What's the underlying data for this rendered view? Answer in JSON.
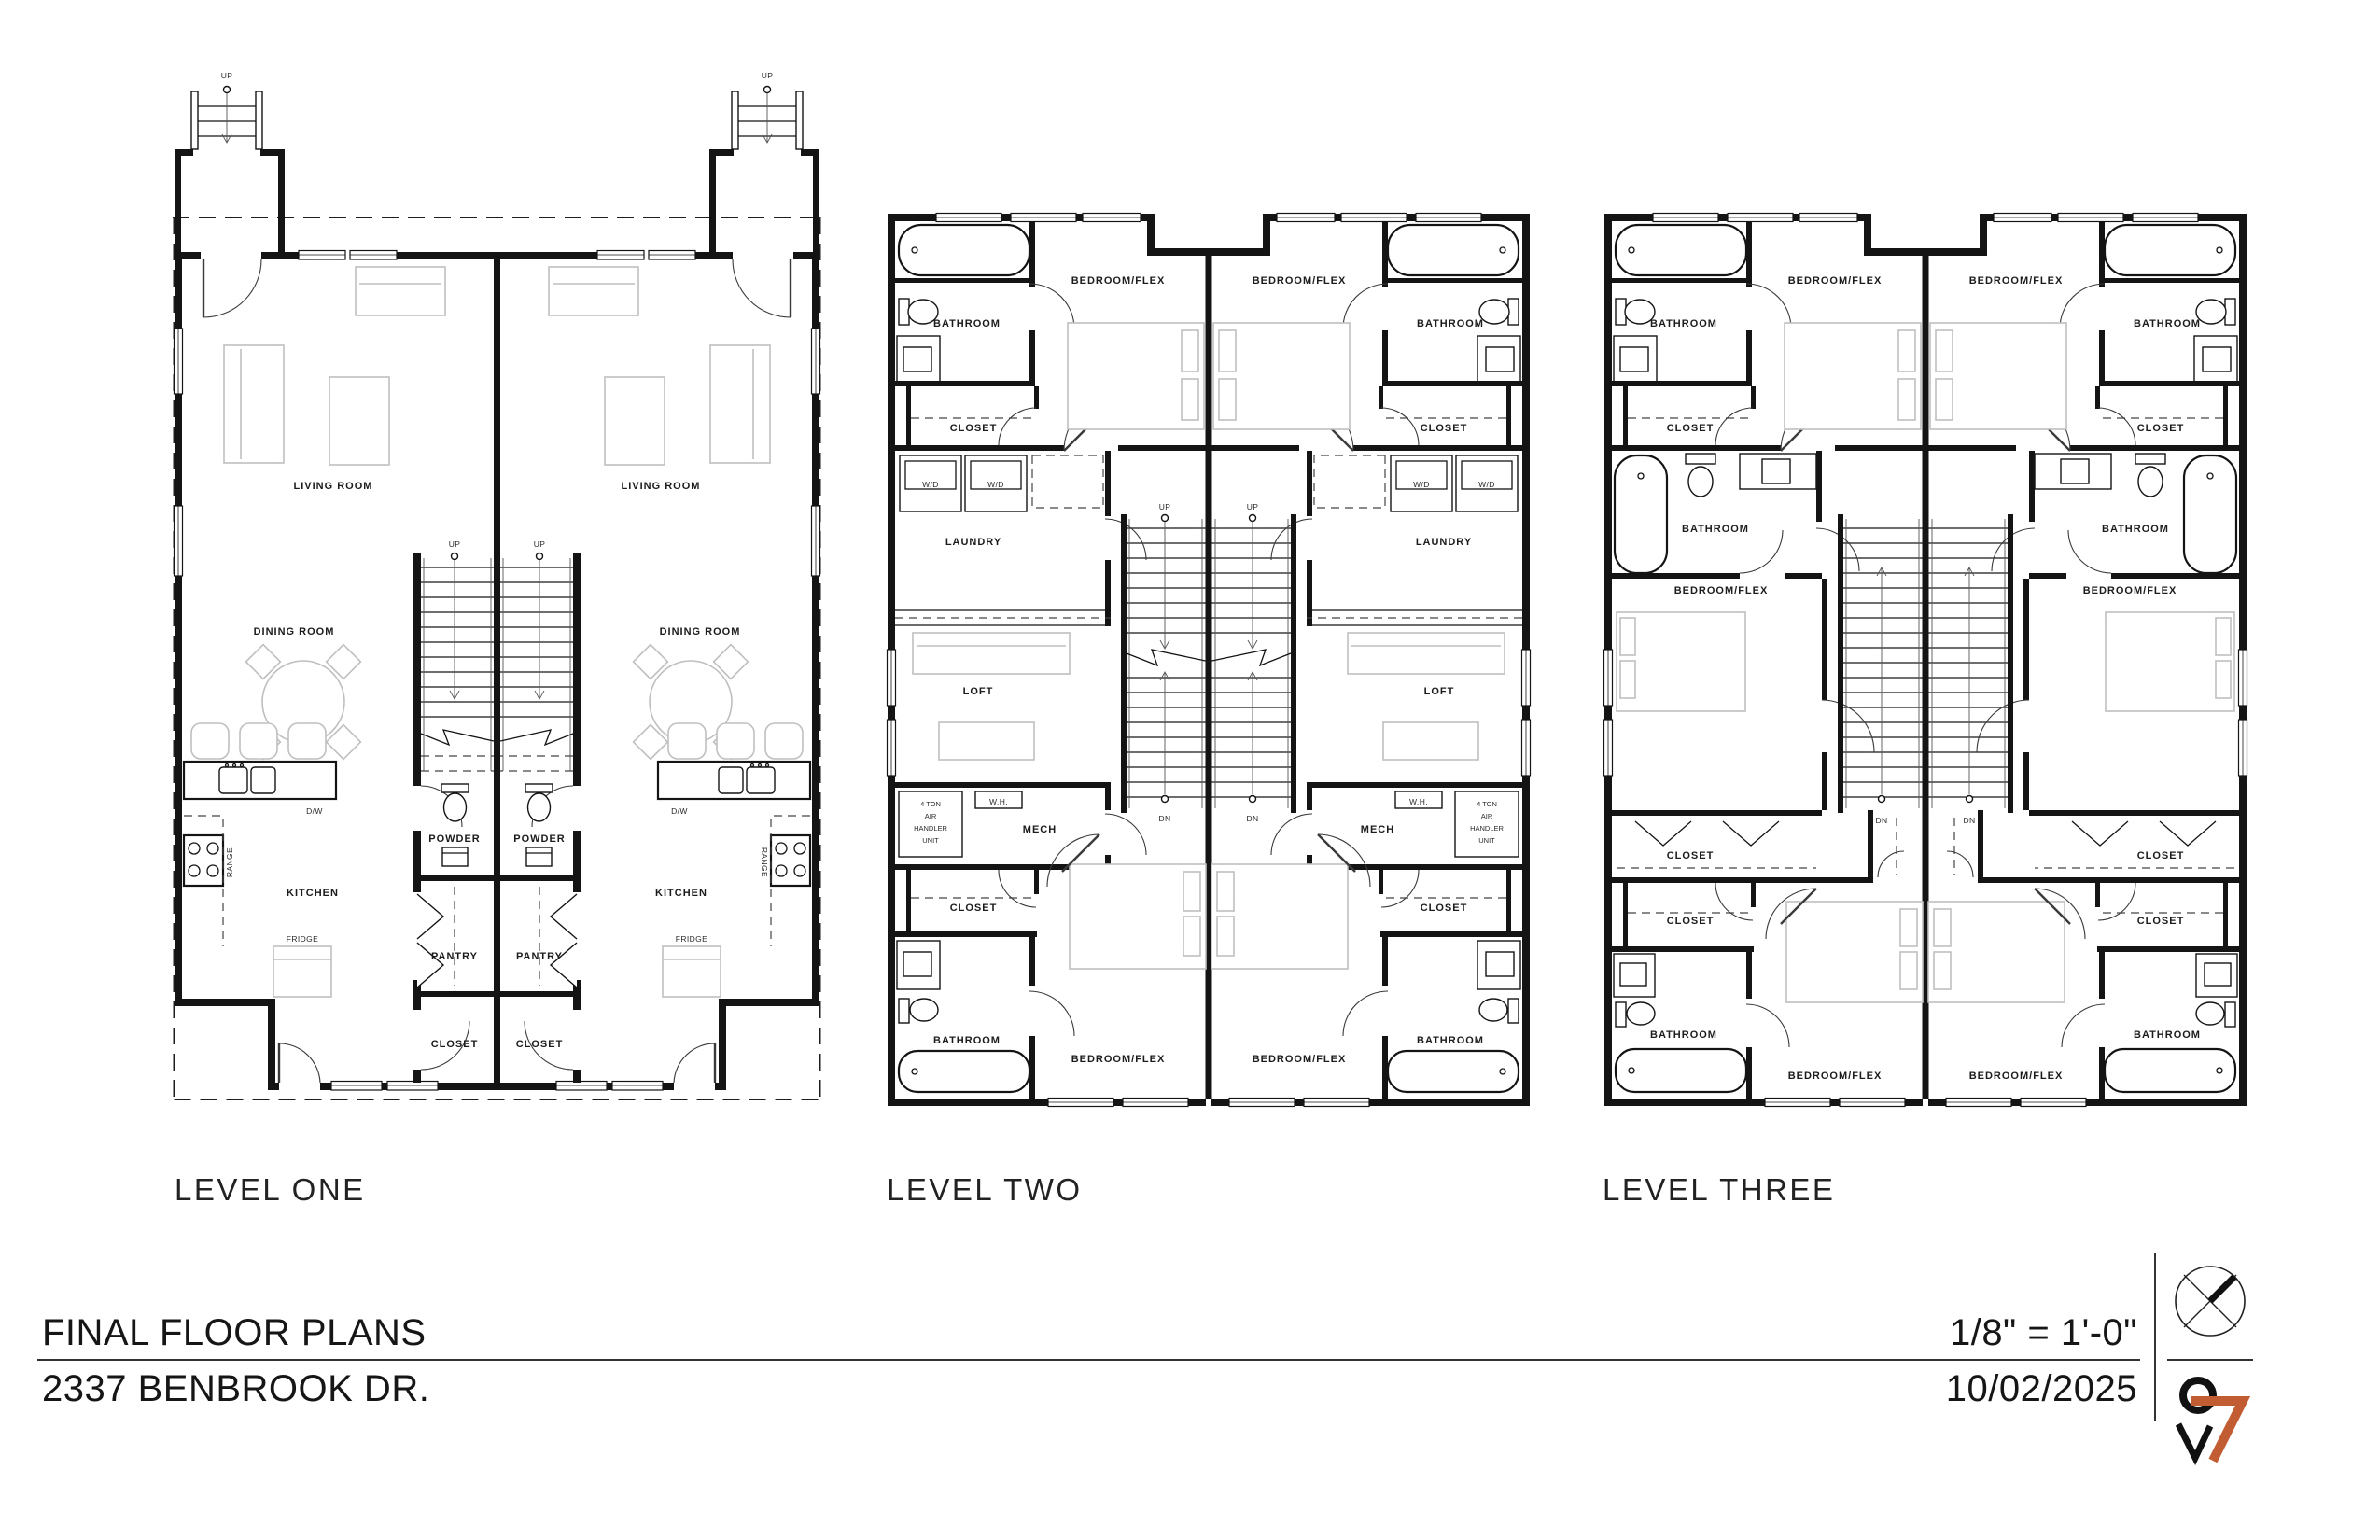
{
  "document": {
    "title": "FINAL FLOOR PLANS",
    "address": "2337 BENBROOK DR.",
    "scale": "1/8\" = 1'-0\"",
    "date": "10/02/2025"
  },
  "titleblock": {
    "logo": {
      "black_digit": "9",
      "orange_digit": "7"
    },
    "colors": {
      "logo_orange": "#C25C33",
      "line": "#333333"
    },
    "icons": [
      "north-arrow-icon",
      "firm-logo-icon"
    ]
  },
  "plans": {
    "level_one": {
      "name": "LEVEL ONE",
      "rooms": {
        "living": "LIVING ROOM",
        "dining": "DINING ROOM",
        "kitchen": "KITCHEN",
        "powder": "POWDER",
        "pantry": "PANTRY",
        "closet": "CLOSET"
      },
      "labels": {
        "up": "UP",
        "dw": "D/W",
        "range": "RANGE",
        "fridge": "FRIDGE"
      }
    },
    "level_two": {
      "name": "LEVEL TWO",
      "rooms": {
        "bedroom_flex": "BEDROOM/FLEX",
        "bathroom": "BATHROOM",
        "closet": "CLOSET",
        "laundry": "LAUNDRY",
        "loft": "LOFT",
        "mech": "MECH"
      },
      "labels": {
        "wd": "W/D",
        "wh": "W.H.",
        "ahu_lines": [
          "4 TON",
          "AIR",
          "HANDLER",
          "UNIT"
        ],
        "up": "UP",
        "dn": "DN"
      }
    },
    "level_three": {
      "name": "LEVEL THREE",
      "rooms": {
        "bedroom_flex": "BEDROOM/FLEX",
        "bathroom": "BATHROOM",
        "closet": "CLOSET"
      },
      "labels": {
        "dn": "DN"
      }
    }
  }
}
